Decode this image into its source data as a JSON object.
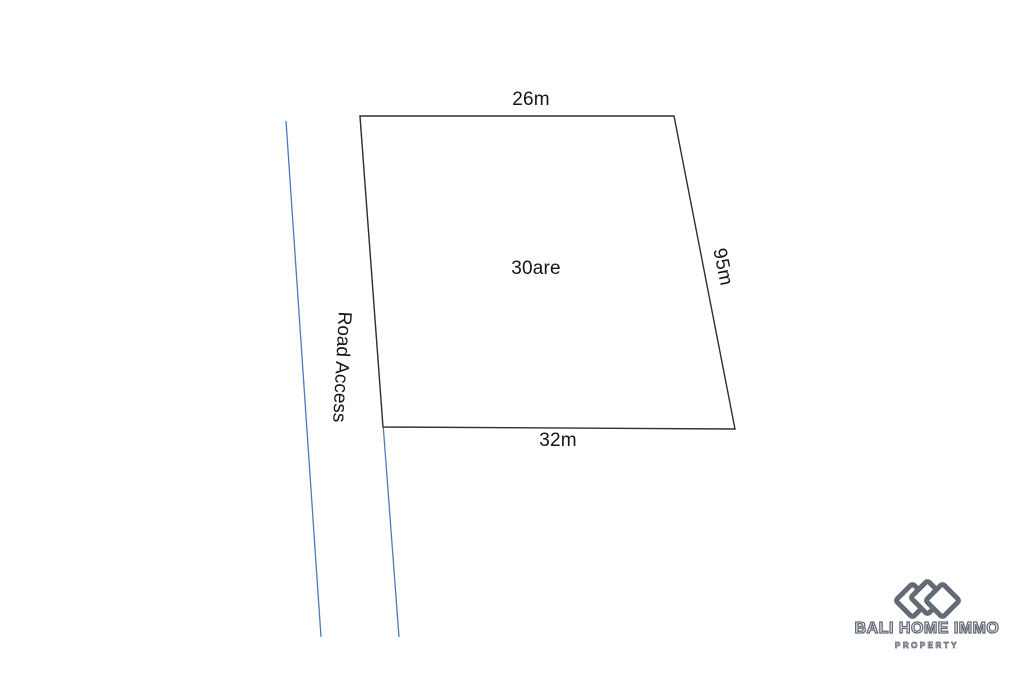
{
  "site_plan": {
    "plot": {
      "area_label": "30are",
      "dimensions": {
        "top": "26m",
        "right": "95m",
        "bottom": "32m"
      }
    },
    "road": {
      "label": "Road Access"
    }
  },
  "colors": {
    "plot_line": "#2f2f2f",
    "road_line": "#4d7bbd",
    "label_text": "#141414",
    "brand": "#636a76"
  },
  "brand": {
    "name": "BALI HOME IMMO",
    "tagline": "PROPERTY",
    "logo_icon": "three-overlapping-diamonds"
  }
}
